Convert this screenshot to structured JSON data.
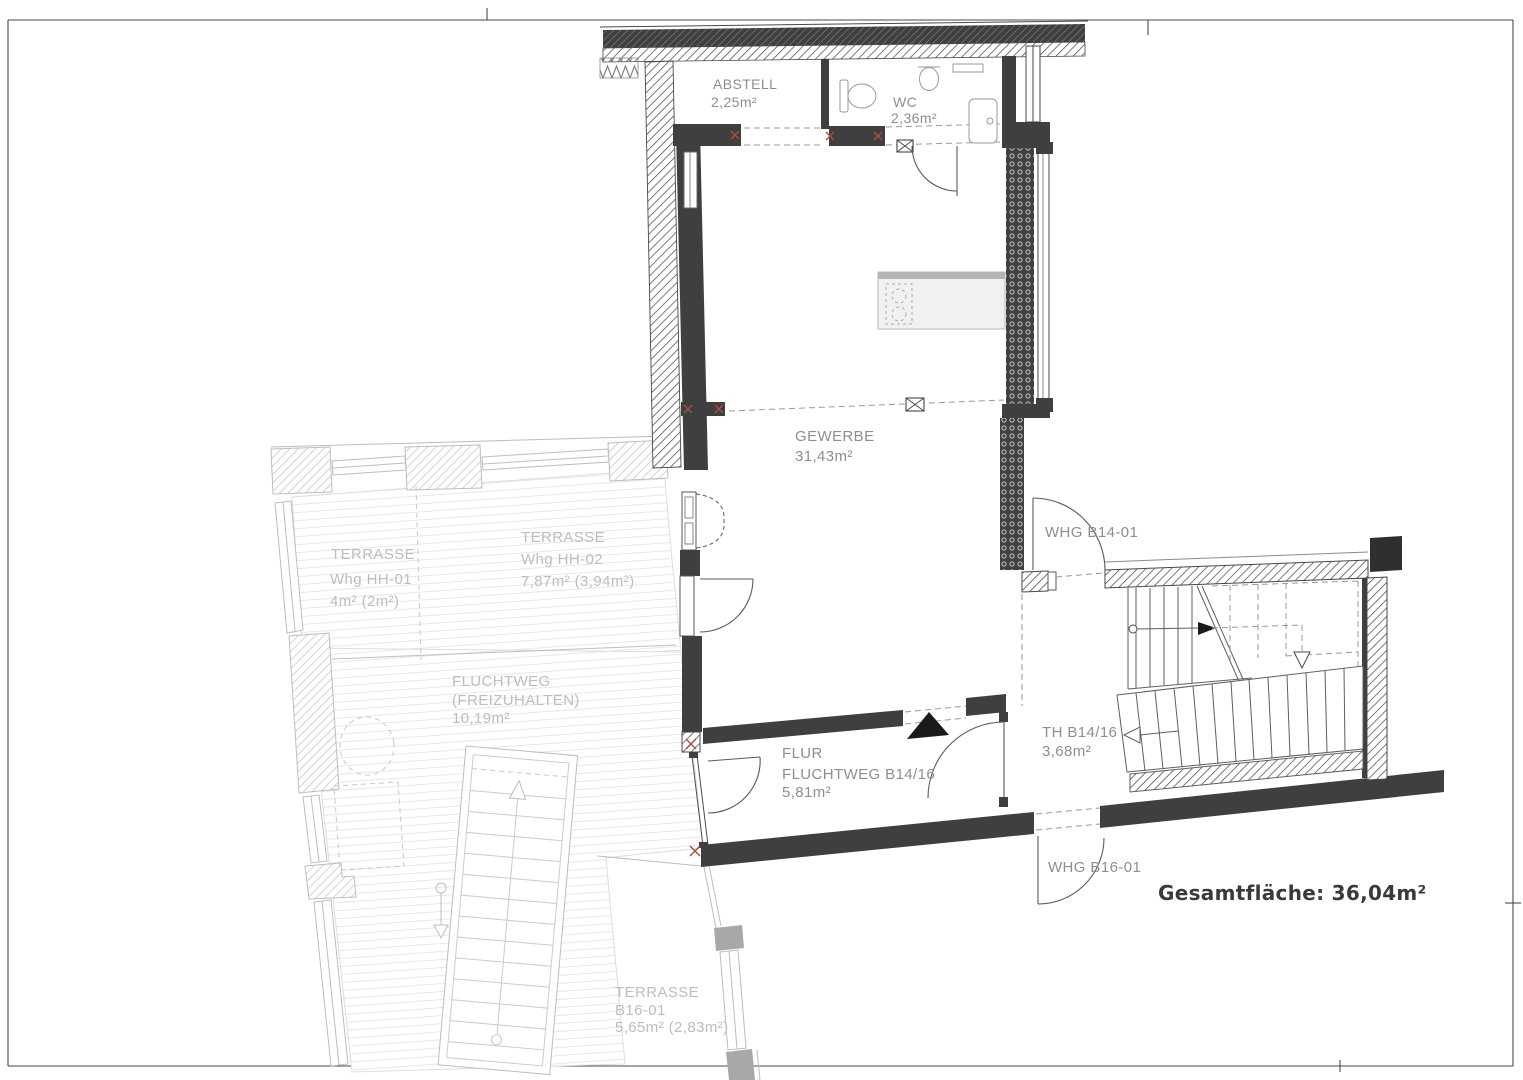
{
  "rooms": {
    "abstell": {
      "name": "ABSTELL",
      "area": "2,25m²"
    },
    "wc": {
      "name": "WC",
      "area": "2,36m²"
    },
    "gewerbe": {
      "name": "GEWERBE",
      "area": "31,43m²"
    },
    "flur": {
      "line1": "FLUR",
      "line2": "FLUCHTWEG B14/16",
      "area": "5,81m²"
    },
    "th": {
      "name": "TH B14/16",
      "area": "3,68m²"
    },
    "terrasse_hh01": {
      "line1": "TERRASSE",
      "line2": "Whg HH-01",
      "area": "4m² (2m²)"
    },
    "terrasse_hh02": {
      "line1": "TERRASSE",
      "line2": "Whg HH-02",
      "area": "7,87m² (3,94m²)"
    },
    "fluchtweg": {
      "line1": "FLUCHTWEG",
      "line2": "(FREIZUHALTEN)",
      "area": "10,19m²"
    },
    "terrasse_b16": {
      "line1": "TERRASSE",
      "line2": "B16-01",
      "area": "5,65m² (2,83m²)"
    }
  },
  "door_labels": {
    "whg_b14_01": "WHG B14-01",
    "whg_b16_01": "WHG B16-01"
  },
  "summary": {
    "total": "Gesamtfläche: 36,04m²"
  },
  "colors": {
    "wall_dark": "#3f3f3f",
    "label_gray": "#8e8e8e",
    "faded_gray": "#bdbdbd",
    "marker_red": "#a8503c",
    "total_text": "#3a3a3a"
  }
}
